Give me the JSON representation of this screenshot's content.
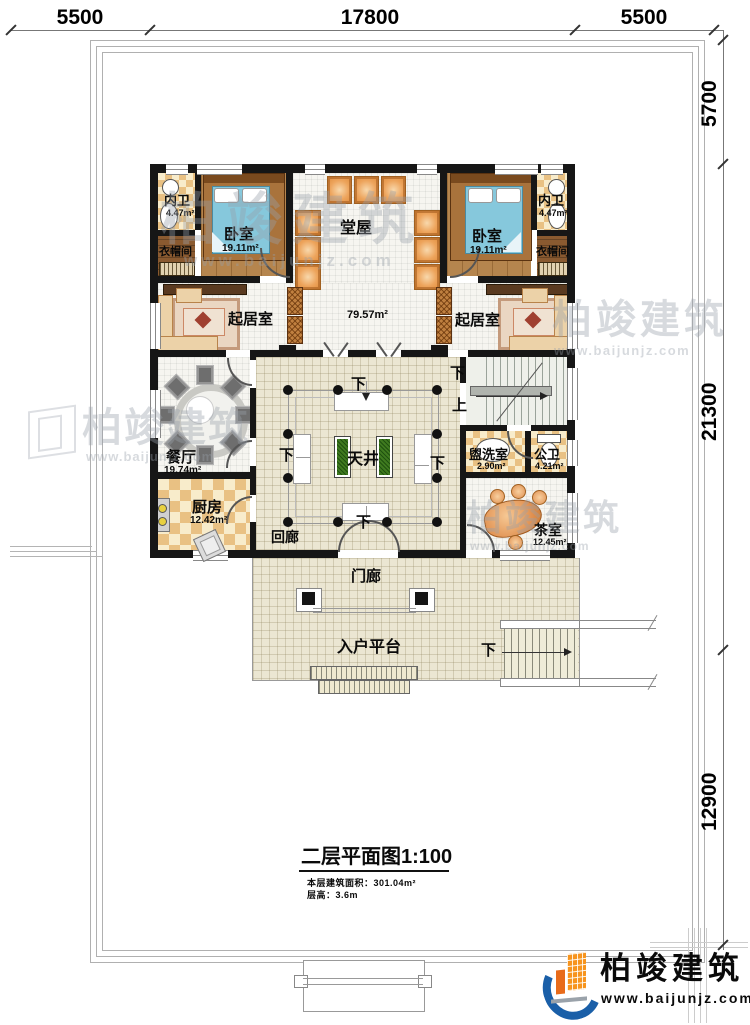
{
  "dims": {
    "top": [
      "5500",
      "17800",
      "5500"
    ],
    "right": [
      "5700",
      "21300",
      "12900"
    ]
  },
  "rooms": {
    "hall": "堂屋",
    "bedroom": "卧室",
    "bedroom_area": "19.11m²",
    "bath": "内卫",
    "bath_area": "4.47m²",
    "cloak": "衣帽间",
    "living": "起居室",
    "living_area": "79.57m²",
    "dining": "餐厅",
    "dining_area": "19.74m²",
    "kitchen": "厨房",
    "kitchen_area": "12.42m²",
    "corridor": "回廊",
    "courtyard": "天井",
    "wash": "盥洗室",
    "wash_area": "2.90m²",
    "toilet": "公卫",
    "toilet_area": "4.21m²",
    "tea": "茶室",
    "tea_area": "12.45m²",
    "porch": "门廊",
    "platform": "入户平台"
  },
  "stairs": {
    "down": "下",
    "up": "上"
  },
  "title": {
    "name": "二层平面图",
    "scale": "1:100",
    "line1": "本层建筑面积：301.04m²",
    "line2": "层高：3.6m"
  },
  "brand": {
    "name": "柏竣建筑",
    "site": "www.baijunjz.com"
  },
  "colors": {
    "wall": "#161616",
    "brand_blue": "#1a5fa8",
    "brand_orange": "#f7941d",
    "checker": "#e9c183",
    "courtyard_green": "#3f7a1f"
  }
}
